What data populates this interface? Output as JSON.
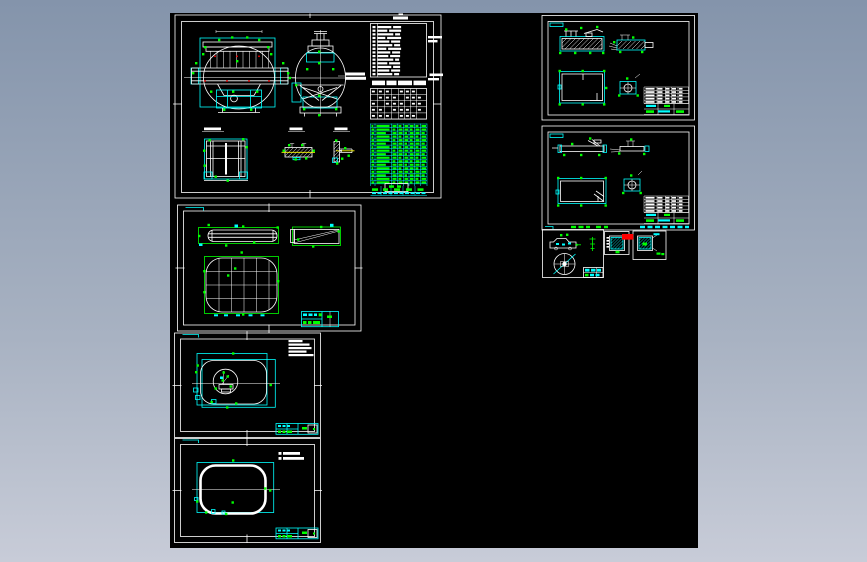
{
  "window": {
    "width": 867,
    "height": 562
  },
  "desktop": {
    "background_top": "#8494ab",
    "background_bottom": "#c8ccd8"
  },
  "viewport": {
    "background": "#000000",
    "x": 170,
    "y": 13,
    "width": 528,
    "height": 535
  },
  "palette": {
    "lines": "#ffffff",
    "frames_tables": "#00ffff",
    "dimensions": "#00ff00",
    "centerlines": "#ffff00",
    "highlight": "#ff0000"
  },
  "sheets": [
    {
      "id": "sheet-1",
      "name": "assembly-drawing-large",
      "views": 5,
      "has_notes_table": true,
      "has_spec_table": true,
      "has_parts_list": true
    },
    {
      "id": "sheet-2",
      "name": "grid-panel-drawing",
      "views": 3,
      "has_title_block": true
    },
    {
      "id": "sheet-3",
      "name": "shell-with-fitting-drawing",
      "views": 1,
      "has_notes": true,
      "has_title_block": true
    },
    {
      "id": "sheet-4",
      "name": "shell-outline-drawing",
      "views": 1,
      "has_notes": true,
      "has_title_block": true
    },
    {
      "id": "sheet-5",
      "name": "bracket-details-upper",
      "views": 4,
      "has_detail_table": true
    },
    {
      "id": "sheet-6",
      "name": "bracket-details-lower",
      "views": 4,
      "has_detail_table": true
    },
    {
      "id": "sheet-7",
      "name": "small-part-and-wheel",
      "views": 3,
      "has_title_block": true
    },
    {
      "id": "sheet-8",
      "name": "small-pad-detail-left",
      "views": 1
    },
    {
      "id": "sheet-9",
      "name": "small-pad-detail-right",
      "views": 1
    }
  ],
  "tables": {
    "notes": {
      "rows": 14
    },
    "spec": {
      "rows": 5,
      "cols": 8
    },
    "parts_list": {
      "rows": 17,
      "cols": 8
    },
    "detail_list": {
      "rows": 5,
      "cols": 5
    }
  }
}
